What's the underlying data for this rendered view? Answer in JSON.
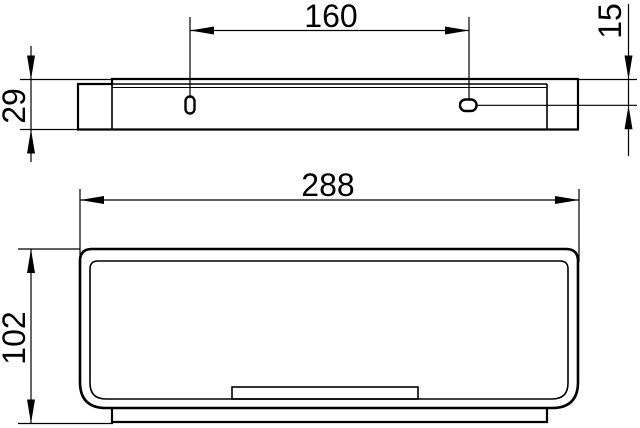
{
  "drawing": {
    "type": "technical-dimension-drawing",
    "units": "mm",
    "background_color": "#ffffff",
    "line_color": "#000000",
    "side_view": {
      "description": "side elevation of wall-mounted shelf rail with two mounting slots",
      "dim_hole_spacing": "160",
      "dim_slot_offset_from_top": "15",
      "dim_rail_height": "29"
    },
    "top_view": {
      "description": "plan view of basket with rounded corners, inner wall, drain tab and wall rail step",
      "dim_overall_width": "288",
      "dim_overall_depth": "102"
    }
  }
}
